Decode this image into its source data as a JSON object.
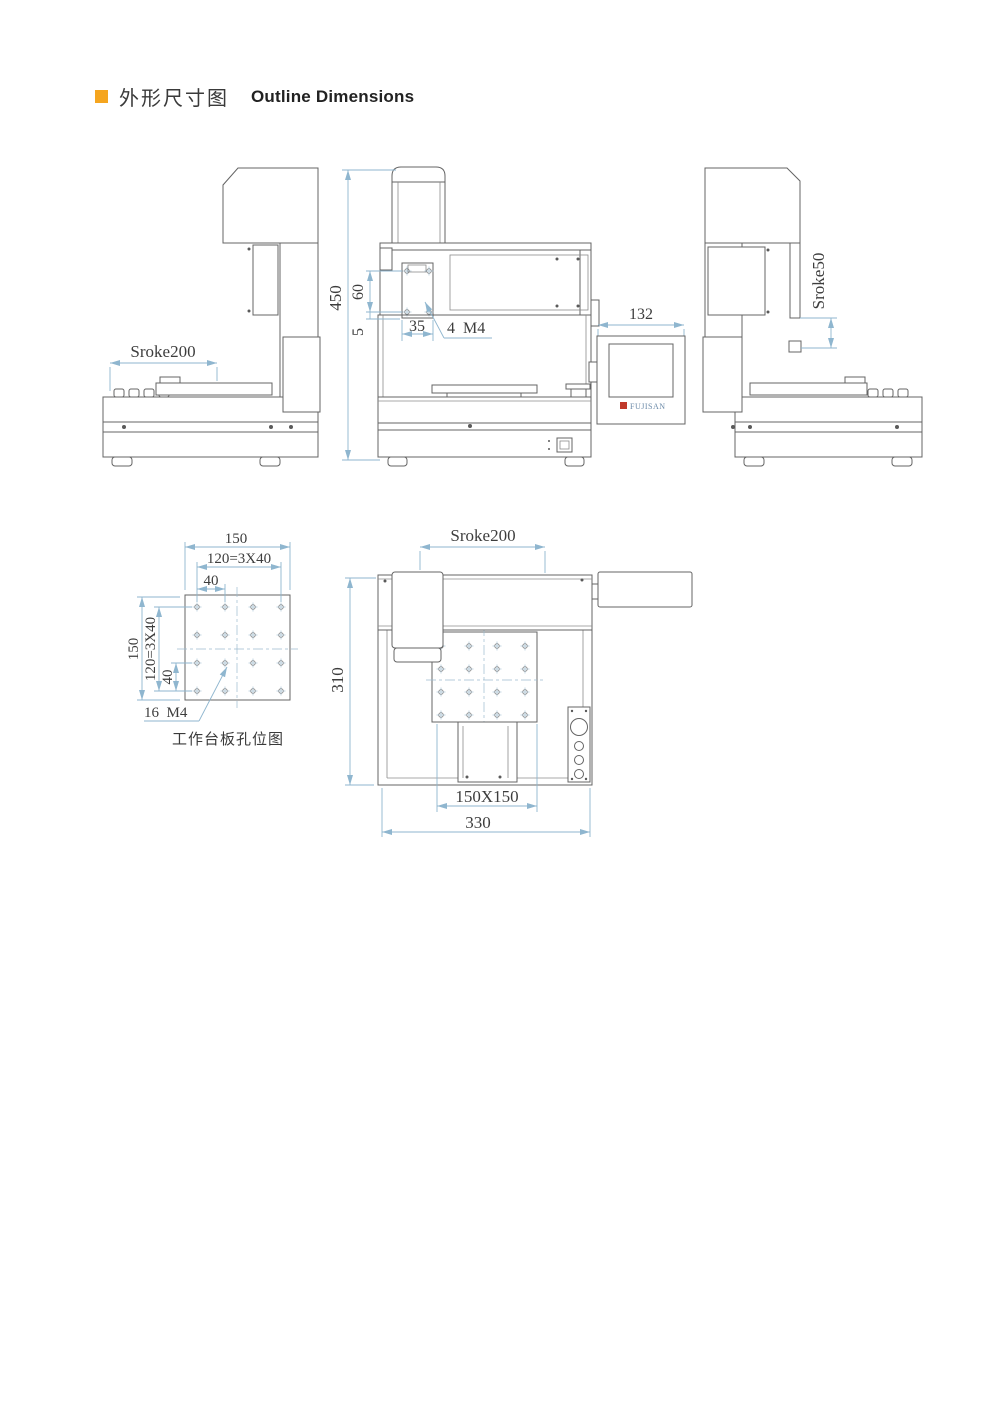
{
  "page": {
    "title_zh": "外形尺寸图",
    "title_en": "Outline Dimensions"
  },
  "colors": {
    "accent": "#F5A51F",
    "dimension_line": "#8FB6CF",
    "drawing_line": "#646464",
    "logo_red": "#C0392B"
  },
  "views": {
    "side_left": {
      "dim_stroke_x": "Sroke200"
    },
    "front": {
      "dim_height": "450",
      "dim_hole_v": "60",
      "dim_offset": "5",
      "dim_hole_h": "35",
      "label_holes": "4  M4",
      "dim_pendant": "132",
      "pendant_logo": "FUJISAN"
    },
    "side_right": {
      "dim_stroke_z": "Sroke50"
    },
    "plate": {
      "dim_top_150": "150",
      "dim_top_120": "120=3X40",
      "dim_top_40": "40",
      "dim_left_150": "150",
      "dim_left_120": "120=3X40",
      "dim_left_40": "40",
      "label_holes": "16  M4",
      "caption": "工作台板孔位图"
    },
    "top": {
      "dim_stroke_x": "Sroke200",
      "dim_depth": "310",
      "dim_table": "150X150",
      "dim_width": "330"
    }
  }
}
